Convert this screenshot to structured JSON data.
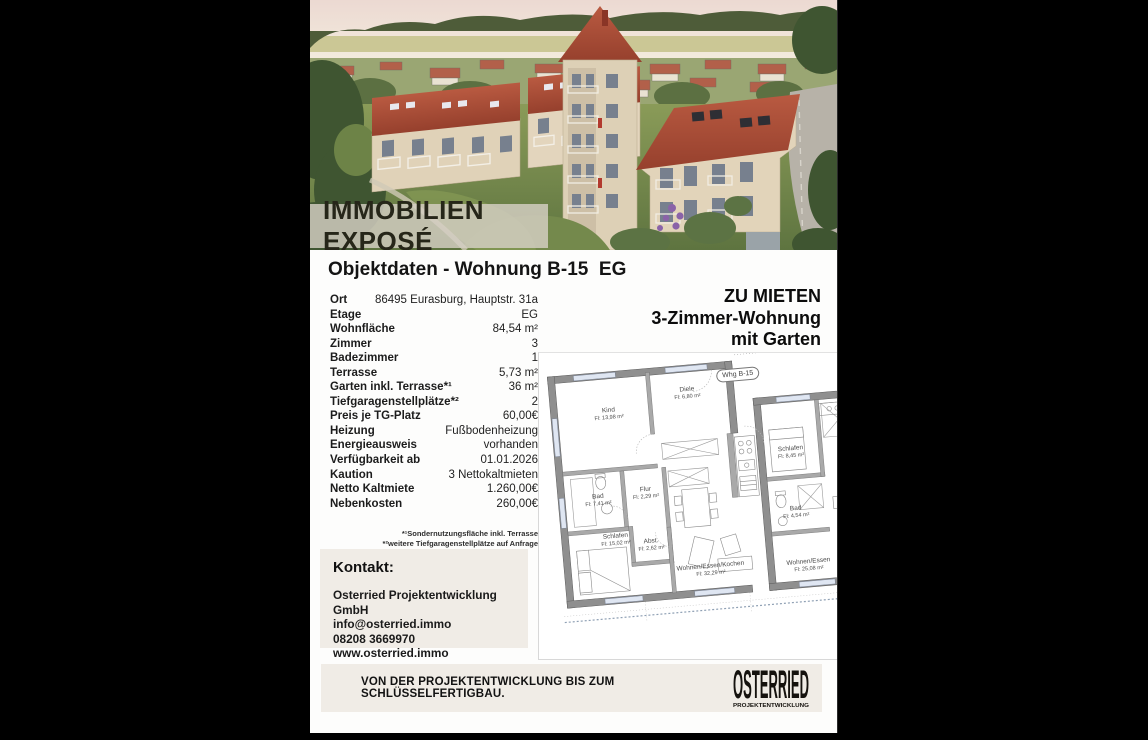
{
  "hero": {
    "banner": "IMMOBILIEN EXPOSÉ",
    "description": "aerial render of residential project with red-roofed buildings"
  },
  "title": "Objektdaten - Wohnung B-15  EG",
  "listing": {
    "rows": [
      {
        "label": "Ort",
        "value": "86495 Eurasburg, Hauptstr. 31a"
      },
      {
        "label": "Etage",
        "value": "EG"
      },
      {
        "label": "Wohnfläche",
        "value": "84,54 m²"
      },
      {
        "label": "Zimmer",
        "value": "3"
      },
      {
        "label": "Badezimmer",
        "value": "1"
      },
      {
        "label": "Terrasse",
        "value": "5,73 m²"
      },
      {
        "label": "Garten inkl. Terrasse*¹",
        "value": "36 m²"
      },
      {
        "label": "Tiefgaragenstellplätze*²",
        "value": "2"
      },
      {
        "label": "Preis je TG-Platz",
        "value": "60,00€"
      },
      {
        "label": "Heizung",
        "value": "Fußbodenheizung"
      },
      {
        "label": "Energieausweis",
        "value": "vorhanden"
      },
      {
        "label": "Verfügbarkeit ab",
        "value": "01.01.2026"
      },
      {
        "label": "Kaution",
        "value": "3 Nettokaltmieten"
      },
      {
        "label": "Netto Kaltmiete",
        "value": "1.260,00€"
      },
      {
        "label": "Nebenkosten",
        "value": "260,00€"
      }
    ],
    "footnotes": [
      "*¹Sondernutzungsfläche inkl. Terrasse",
      "*²weitere Tiefgaragenstellplätze auf Anfrage"
    ]
  },
  "offer": {
    "line1": "ZU MIETEN",
    "line2": "3-Zimmer-Wohnung",
    "line3": "mit Garten"
  },
  "contact": {
    "heading": "Kontakt:",
    "company": "Osterried Projektentwicklung GmbH",
    "email": "info@osterried.immo",
    "phone": "08208 3669970",
    "website": "www.osterried.immo"
  },
  "floorplan": {
    "unit_label": "Whg B-15",
    "unit_label_2": "W",
    "rooms": [
      {
        "name": "Kind",
        "area": "Fl: 13,98 m²"
      },
      {
        "name": "Diele",
        "area": "Fl: 6,80 m²"
      },
      {
        "name": "Schlafen",
        "area": "Fl: 8,45 m²"
      },
      {
        "name": "Bad",
        "area": "Fl: 7,41 m²"
      },
      {
        "name": "Flur",
        "area": "Fl: 2,29 m²"
      },
      {
        "name": "Abst.",
        "area": "Fl: 2,62 m²"
      },
      {
        "name": "Bad",
        "area": "Fl: 4,54 m²"
      },
      {
        "name": "Schlafen",
        "area": "Fl: 15,02 m²"
      },
      {
        "name": "Wohnen/Essen/Kochen",
        "area": "Fl: 32,29 m²"
      },
      {
        "name": "Wohnen/Essen",
        "area": "Fl: 25,08 m²"
      }
    ]
  },
  "footer": {
    "slogan": "VON DER PROJEKTENTWICKLUNG BIS ZUM SCHLÜSSELFERTIGBAU.",
    "logo_text": "OSTERRIED",
    "logo_sub": "PROJEKTENTWICKLUNG"
  },
  "colors": {
    "panel_beige": "#f0ece6",
    "roof_red": "#ae4c36",
    "banner_overlay": "#d6cfc4",
    "plan_wall_gray": "#8f8f8f",
    "background": "#000000"
  }
}
